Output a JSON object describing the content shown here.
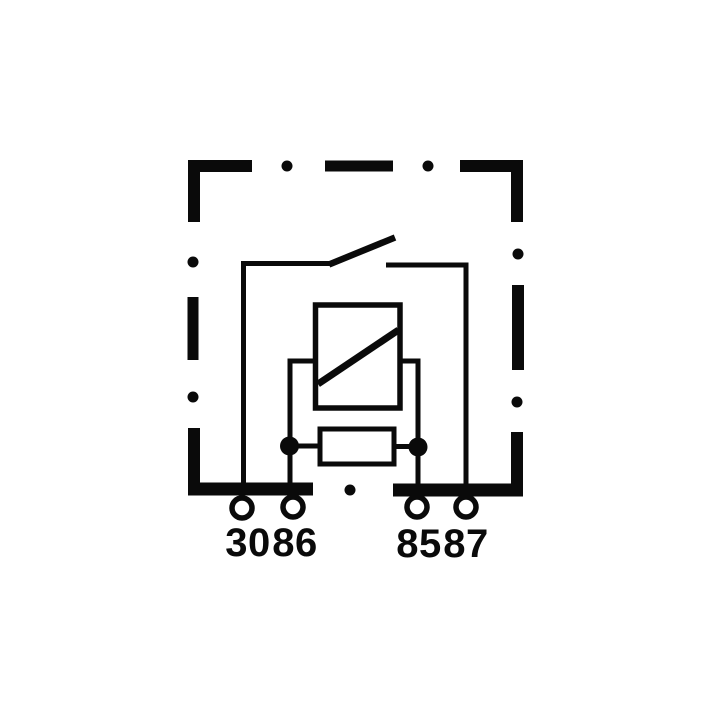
{
  "diagram": {
    "title": "relay-circuit-schematic",
    "colors": {
      "line": "#0a0a0a",
      "background": "#ffffff"
    },
    "terminals": [
      {
        "label": "30"
      },
      {
        "label": "86"
      },
      {
        "label": "85"
      },
      {
        "label": "87"
      }
    ]
  }
}
